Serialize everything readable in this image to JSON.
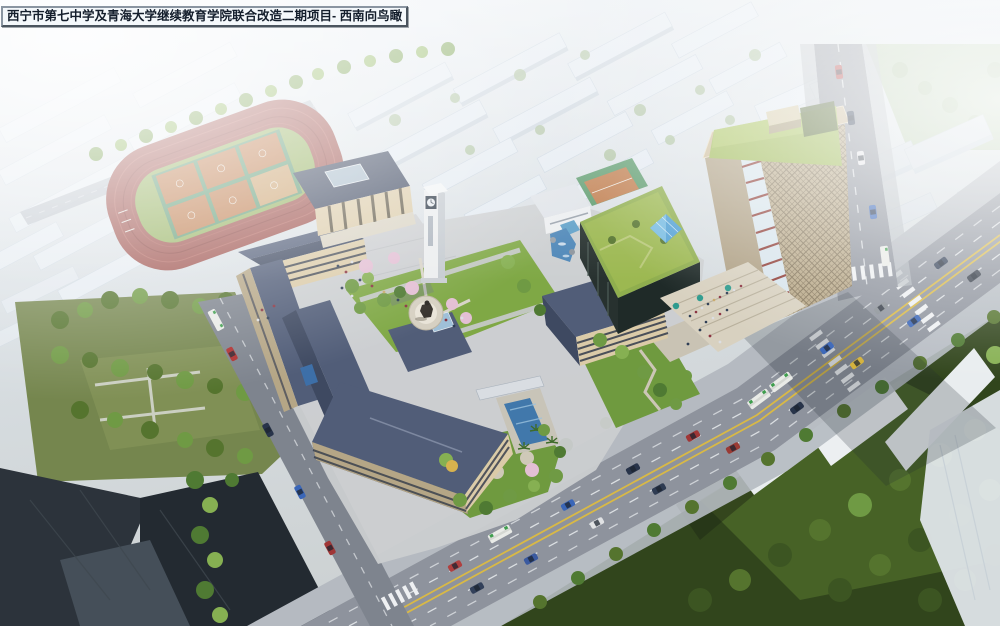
{
  "title": {
    "text": "西宁市第七中学及青海大学继续教育学院联合改造二期项目- 西南向鸟瞰"
  },
  "scene": {
    "kind": "architectural aerial rendering",
    "view": "southwest bird's-eye view",
    "landmarks": [
      {
        "name": "running-track",
        "desc": "red running track with green infield and six orange basketball courts"
      },
      {
        "name": "auditorium",
        "desc": "colonnaded hall with dark hip roof and central skylight"
      },
      {
        "name": "clock-tower",
        "desc": "white campus clock tower with dark clock face"
      },
      {
        "name": "statue-plaza",
        "desc": "circular plaza with dark statue at the courtyard center"
      },
      {
        "name": "classroom-wings",
        "desc": "beige classroom buildings with slate-blue tiled roofs"
      },
      {
        "name": "south-building",
        "desc": "large hip-roof building with ribbon windows and garden"
      },
      {
        "name": "highrise-tower",
        "desc": "high-rise with diamond-grid facade, red-banded curved glass corner and planted green roof"
      },
      {
        "name": "podium",
        "desc": "glass podium with green roof, blue glass pyramid skylight and rooftop basketball court"
      },
      {
        "name": "grand-stairs",
        "desc": "wide entry steps with pedestrians and teal umbrellas"
      },
      {
        "name": "main-boulevard",
        "desc": "wide avenue with double yellow median, buses and cars"
      },
      {
        "name": "west-street",
        "desc": "side street along the campus west edge"
      },
      {
        "name": "city-context",
        "desc": "hazy white massing blocks of the surrounding city"
      },
      {
        "name": "south-park",
        "desc": "dense tree-canopy park southeast of the avenue"
      }
    ]
  },
  "palette": {
    "haze": "#e8eef4",
    "sky_glare": "#fbfdfe",
    "track_red": "#9e524d",
    "field_green": "#93b05d",
    "court_orange": "#bd7a4a",
    "court_apron": "#5b9770",
    "roof_slate": "#515d78",
    "roof_shade": "#3e4961",
    "wall_beige": "#dbcba8",
    "wall_shade": "#b5a686",
    "window_dark": "#2e3547",
    "lawn": "#7fa845",
    "tree_dark": "#3c5522",
    "tree_mid": "#55742e",
    "tree_light": "#86b052",
    "blossom_pink": "#e3bfd4",
    "asphalt": "#8e939d",
    "lane_yellow": "#d9b945",
    "marking_white": "#eceff2",
    "tower_facade": "#c7b593",
    "tower_green_roof": "#9cb851",
    "tower_red_accent": "#8e3c35",
    "glass_blue": "#4f9fd4",
    "stair_stone": "#d8d1c0",
    "umbrella_teal": "#2e9b8e",
    "context_white": "#e6edf4",
    "dark_roofs": "#2c333b"
  }
}
